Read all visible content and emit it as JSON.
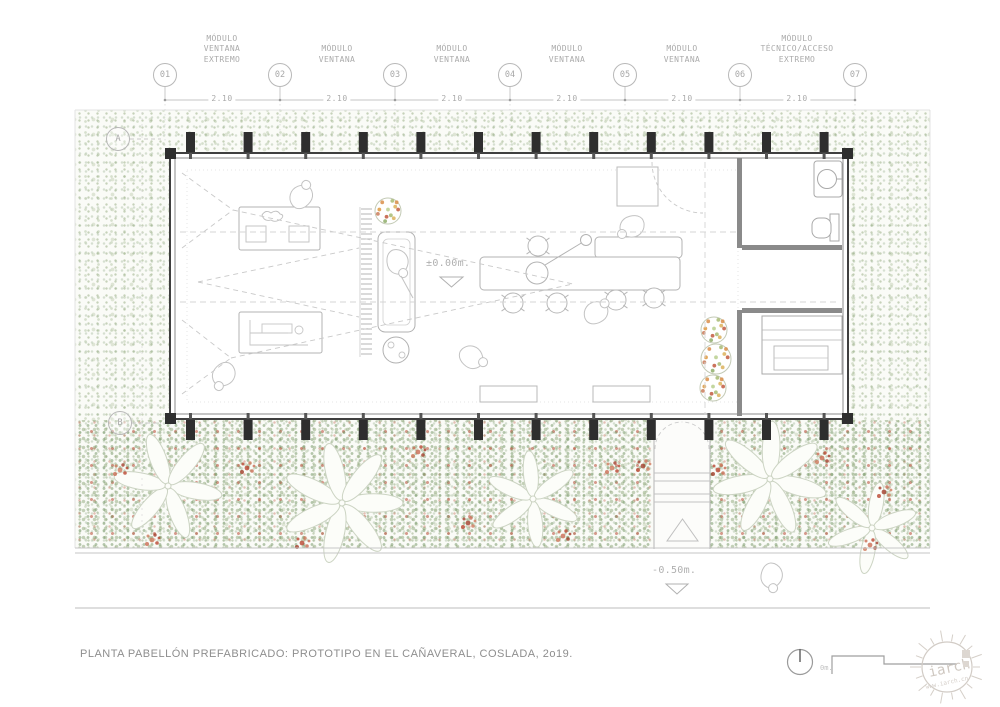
{
  "header": {
    "module_labels": [
      "MÓDULO\nVENTANA\nEXTREMO",
      "MÓDULO\nVENTANA",
      "MÓDULO\nVENTANA",
      "MÓDULO\nVENTANA",
      "MÓDULO\nVENTANA",
      "MÓDULO\nTÉCNICO/ACCESO\nEXTREMO"
    ],
    "grid_bubbles": [
      "01",
      "02",
      "03",
      "04",
      "05",
      "06",
      "07"
    ],
    "dimensions": [
      "2.10",
      "2.10",
      "2.10",
      "2.10",
      "2.10",
      "2.10"
    ],
    "row_bubbles": [
      "A",
      "B"
    ]
  },
  "annotations": {
    "level_interior": "±0.00m.",
    "level_exterior": "-0.50m."
  },
  "footer": {
    "title": "PLANTA PABELLÓN PREFABRICADO: PROTOTIPO EN EL CAÑAVERAL, COSLADA, 2o19.",
    "scale_zero": "0m."
  },
  "watermark": {
    "logo_text": "iarch",
    "site": "www.iarch.cn"
  },
  "colors": {
    "wall_dark": "#3f3f3f",
    "column_black": "#2e2e2e",
    "line_mid": "#9a9a9a",
    "line_light": "#c9c9c9",
    "text_gray": "#ababab",
    "veg_green": "#a9bd92",
    "flower_red": "#b9452f",
    "plant_orange": "#d98e4a"
  }
}
